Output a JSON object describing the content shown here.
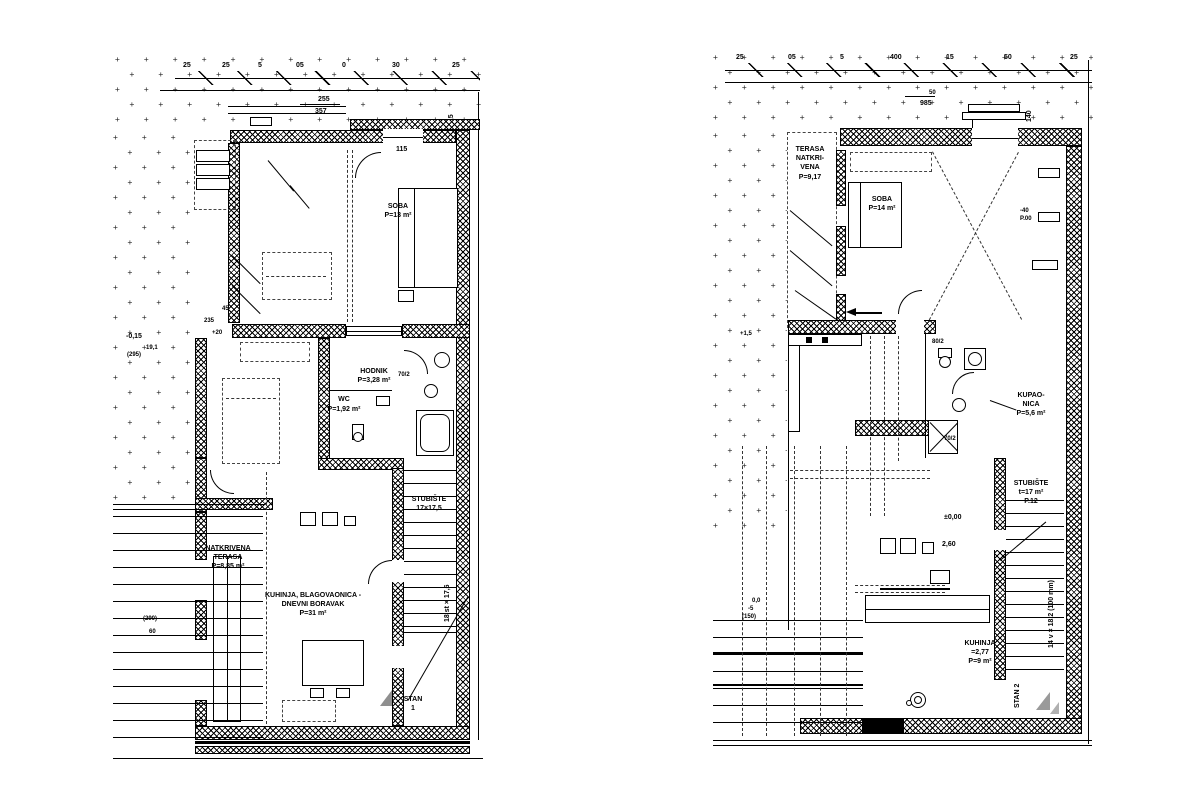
{
  "drawing": {
    "background": "#ffffff",
    "ink": "#000000",
    "stipple_char": "+",
    "left_unit": {
      "dims": {
        "row": [
          "25",
          "25",
          "5",
          "05",
          "0",
          "30",
          "25"
        ],
        "total1": "255",
        "total2": "357",
        "side": "14,5",
        "door": "115",
        "d1": "235",
        "d2": "45",
        "d3": "+20",
        "note70": "70/2"
      },
      "rooms": {
        "soba": {
          "name": "SOBA",
          "area": "P=13 m²"
        },
        "hodnik": {
          "name": "HODNIK",
          "area": "P=3,28 m²"
        },
        "wc": {
          "name": "WC",
          "area": "P=1,92 m²"
        },
        "kuhinja": {
          "line1": "KUHINJA, BLAGOVAONICA -",
          "line2": "DNEVNI BORAVAK",
          "area": "P=31 m²"
        },
        "terasa": {
          "line1": "NATKRIVENA",
          "line2": "TERASA",
          "area": "P=8,85 m²"
        },
        "stubiste": {
          "name": "STUBIŠTE",
          "note": "17×17,5",
          "vert": "18 st × 17,6"
        }
      },
      "levels": {
        "a": "-0,15",
        "b": "19,1",
        "c": "(295)",
        "d": "(290)",
        "e": "60"
      },
      "unit": {
        "line1": "STAN",
        "line2": "1"
      }
    },
    "right_unit": {
      "dims": {
        "row": [
          "25",
          "05",
          "5",
          "400",
          "15",
          "50",
          "25"
        ],
        "total": "985",
        "sub": "50",
        "side": "140",
        "d40": "-40",
        "p00": "P.00",
        "door80": "80/2",
        "door70": "70/2",
        "plus": "+1,5"
      },
      "rooms": {
        "terasa": {
          "line1": "TERASA",
          "line2": "NATKRI-",
          "line3": "VENA",
          "area": "P=9,17"
        },
        "soba": {
          "name": "SOBA",
          "area": "P=14 m²"
        },
        "kupaonica": {
          "line1": "KUPAO-",
          "line2": "NICA",
          "area": "P=5,6 m²"
        },
        "stubiste": {
          "name": "STUBIŠTE",
          "note": "t=17 m²",
          "note2": "P.12",
          "vert": "14 v × 18,2 (100 mm)"
        },
        "kuhinja": {
          "name": "KUHINJA",
          "note": "=2,77",
          "area": "P=9 m²"
        }
      },
      "levels": {
        "a": "±0,00",
        "b": "2,60",
        "c": "0,0",
        "d": "-5",
        "e": "(150)"
      },
      "unit": {
        "label": "STAN 2"
      }
    }
  }
}
